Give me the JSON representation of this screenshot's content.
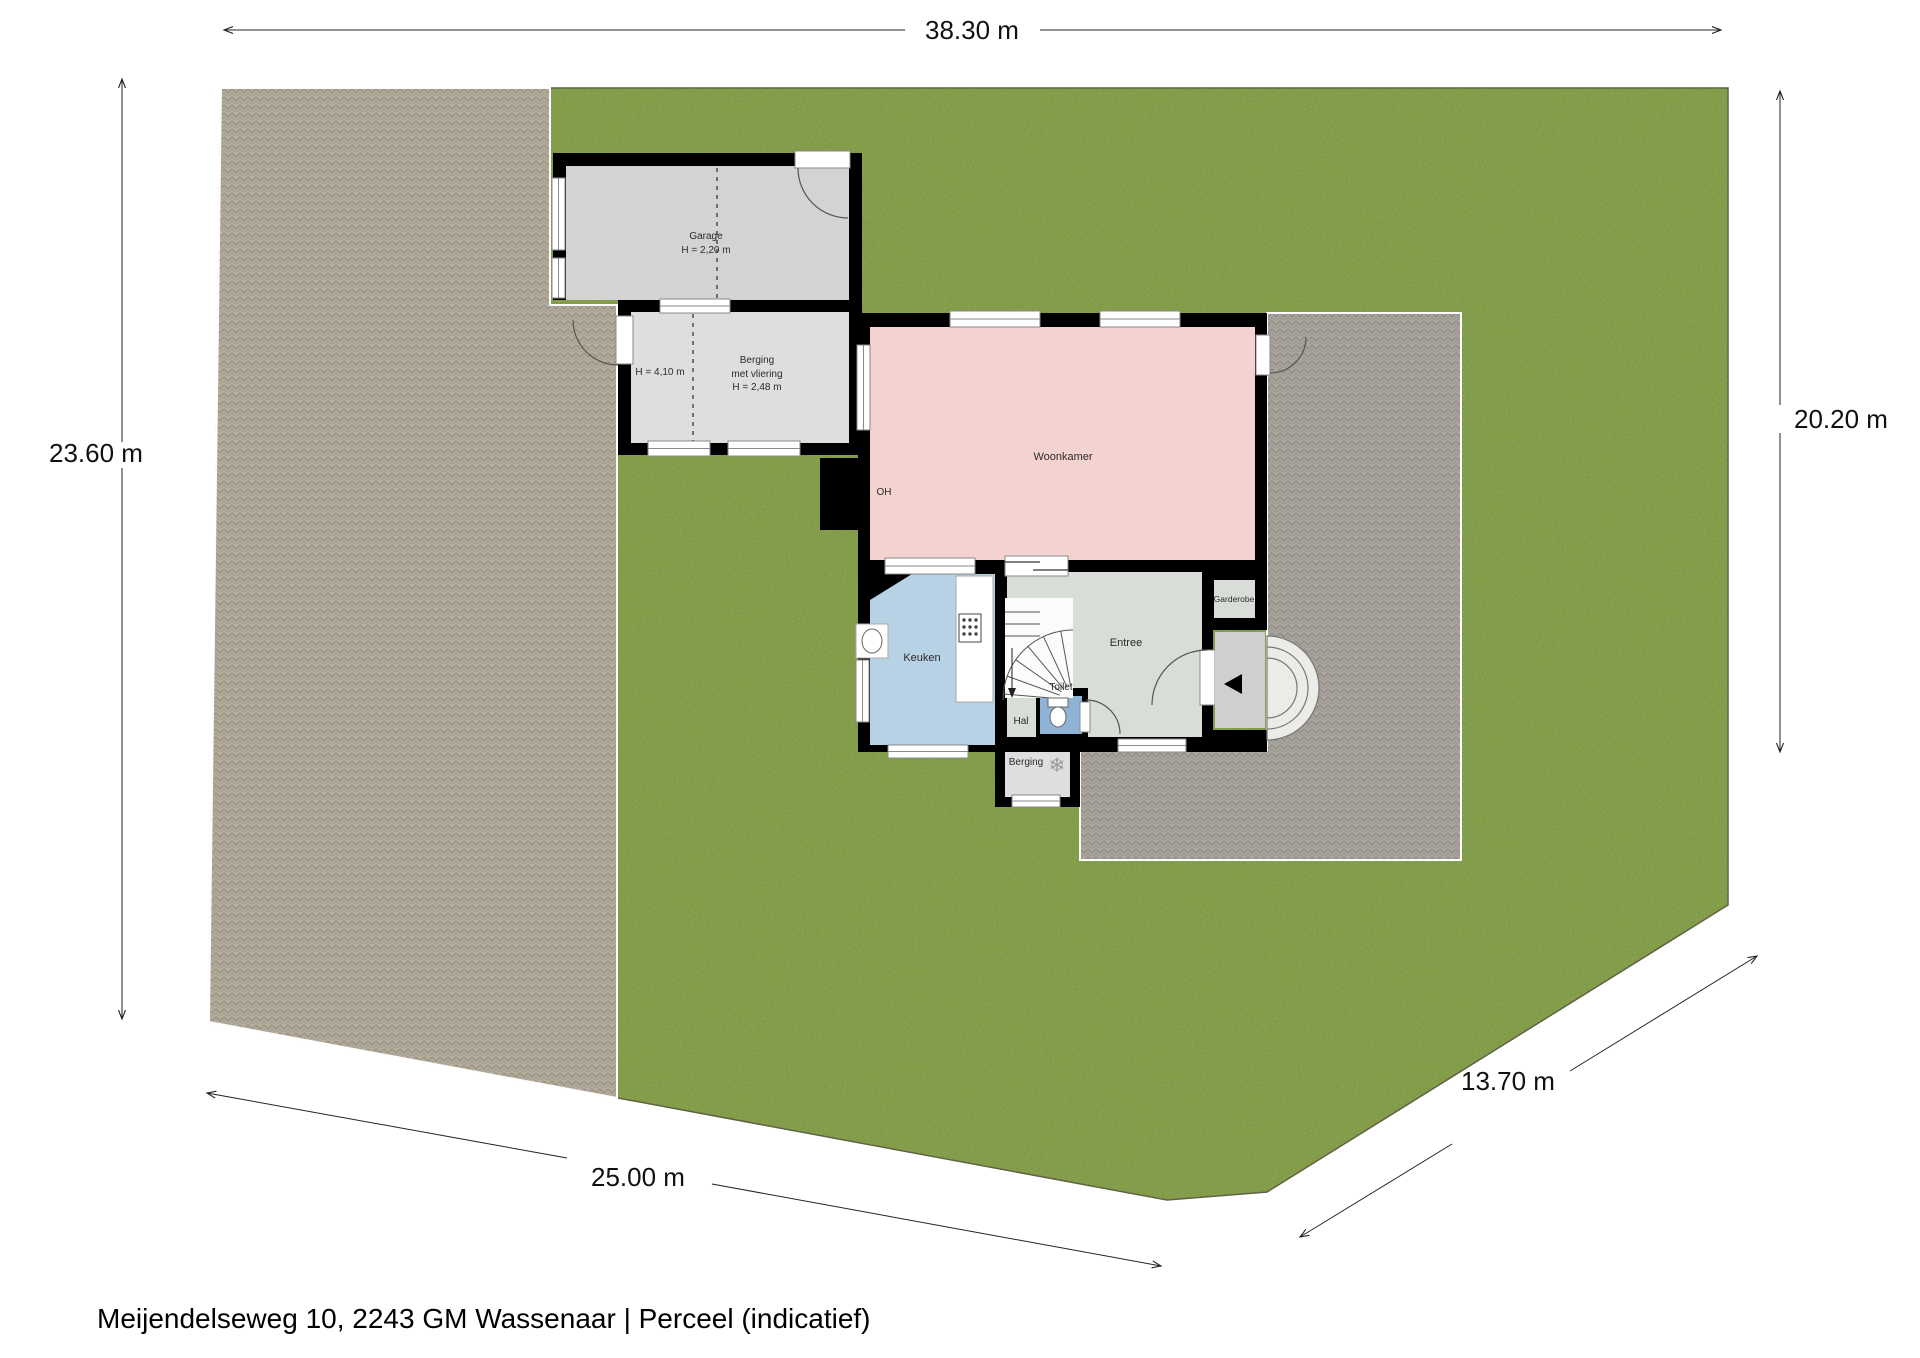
{
  "caption": {
    "text": "Meijendelseweg 10, 2243 GM Wassenaar | Perceel (indicatief)"
  },
  "dimensions": {
    "top": "38.30 m",
    "left": "23.60 m",
    "right": "20.20 m",
    "bottom": "25.00 m",
    "diagonal": "13.70 m"
  },
  "rooms": {
    "garage": {
      "name": "Garage",
      "height": "H = 2,20 m"
    },
    "annex_left_height": "H = 4,10 m",
    "berging_annex": {
      "name": "Berging",
      "sub": "met vliering",
      "height": "H = 2,48 m"
    },
    "woonkamer": {
      "name": "Woonkamer"
    },
    "fireplace_label": "OH",
    "keuken": {
      "name": "Keuken"
    },
    "hal": {
      "name": "Hal"
    },
    "toilet": {
      "name": "Toilet"
    },
    "berging_small": {
      "name": "Berging"
    },
    "entree": {
      "name": "Entree"
    },
    "garderobe": {
      "name": "Garderobe"
    }
  },
  "icons": {
    "freezer": "❄"
  },
  "colors": {
    "grass": "#7d9a3e",
    "driveway": "#b3ab9b",
    "terrace": "#a8a49c",
    "wall": "#000000",
    "garage": "#d3d3d3",
    "annex": "#dedede",
    "woonkamer": "#f3d2cf",
    "keuken": "#b7d1e5",
    "toilet": "#8fb3d6",
    "gray_room": "#d9ddd8",
    "porch": "#cfcfcf"
  }
}
